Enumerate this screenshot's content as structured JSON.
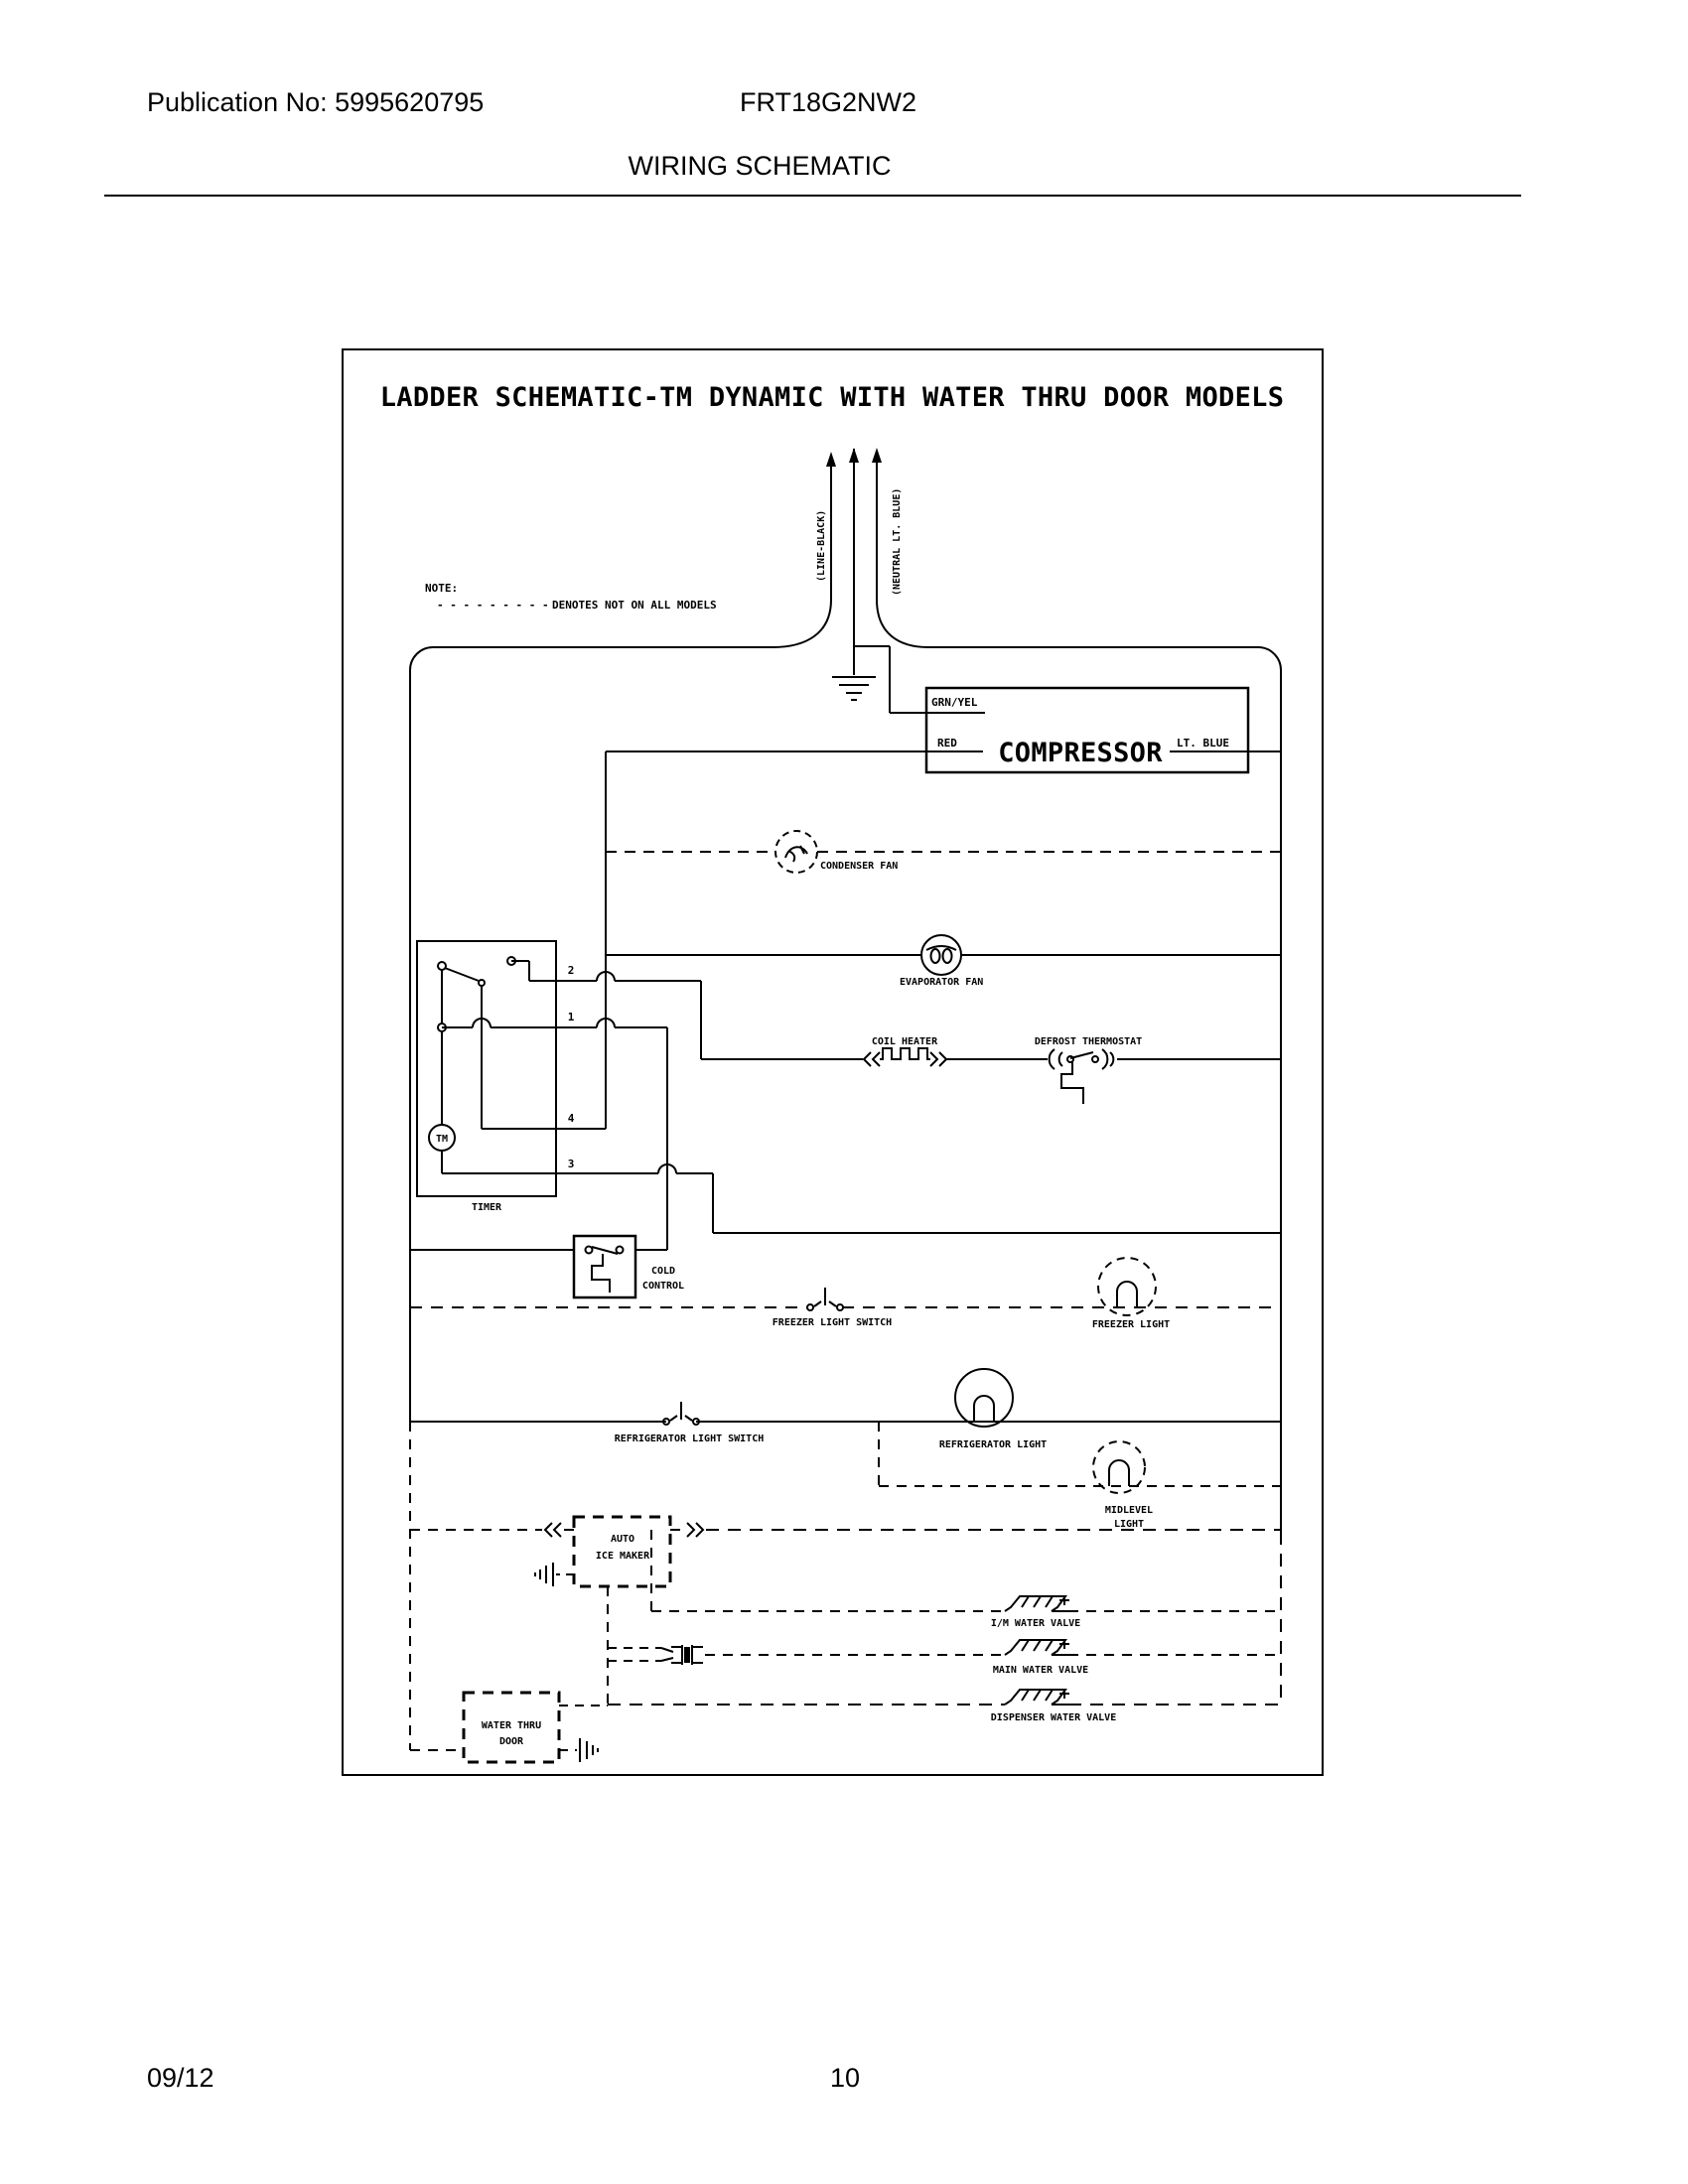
{
  "page": {
    "header": {
      "publication": "Publication No: 5995620795",
      "model": "FRT18G2NW2",
      "section_title": "WIRING SCHEMATIC"
    },
    "footer": {
      "date": "09/12",
      "page_number": "10"
    }
  },
  "schematic": {
    "title": "LADDER SCHEMATIC-TM DYNAMIC WITH WATER THRU DOOR MODELS",
    "note": {
      "label": "NOTE:",
      "dashes": "- - - - - - - - -",
      "text": "DENOTES NOT ON ALL MODELS"
    },
    "supply": {
      "line_label": "(LINE-BLACK)",
      "neutral_label": "(NEUTRAL LT. BLUE)"
    },
    "compressor": {
      "label": "COMPRESSOR",
      "wire_top": "GRN/YEL",
      "wire_left": "RED",
      "wire_right": "LT. BLUE"
    },
    "components": {
      "condenser_fan": "CONDENSER FAN",
      "evaporator_fan": "EVAPORATOR FAN",
      "coil_heater": "COIL HEATER",
      "defrost_thermostat": "DEFROST THERMOSTAT",
      "timer": "TIMER",
      "timer_motor": "TM",
      "timer_terminals": {
        "t2": "2",
        "t1": "1",
        "t4": "4",
        "t3": "3"
      },
      "cold_control": [
        "COLD",
        "CONTROL"
      ],
      "freezer_light_switch": "FREEZER LIGHT SWITCH",
      "freezer_light": "FREEZER LIGHT",
      "refrigerator_light_switch": "REFRIGERATOR LIGHT SWITCH",
      "refrigerator_light": "REFRIGERATOR LIGHT",
      "midlevel_light": [
        "MIDLEVEL",
        "LIGHT"
      ],
      "auto_ice_maker": [
        "AUTO",
        "ICE MAKER"
      ],
      "im_water_valve": "I/M WATER VALVE",
      "main_water_valve": "MAIN WATER VALVE",
      "dispenser_water_valve": "DISPENSER WATER VALVE",
      "water_thru_door": [
        "WATER THRU",
        "DOOR"
      ]
    }
  }
}
